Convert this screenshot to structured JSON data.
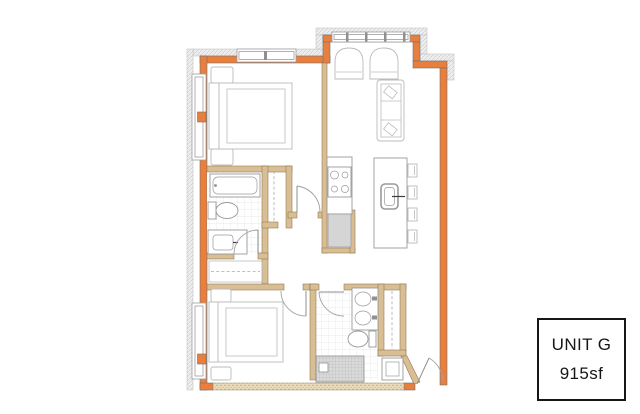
{
  "unit_label": {
    "name": "UNIT G",
    "area": "915sf"
  },
  "colors": {
    "exterior_wall": "#E87F3D",
    "interior_wall": "#D9BE93",
    "interior_wall_edge": "#8A7350",
    "wall_edge": "#707070",
    "hatch_fill": "#EDEDED",
    "hatch_line": "#BDBDBD",
    "fixture_line": "#9A9A9A",
    "furniture_line": "#BBBBBB",
    "appliance_fill": "#D5D5D5",
    "tile_line": "#E4E4E4",
    "shower_fill": "#DADADA",
    "shower_line": "#AFAFAF",
    "corridor_wall_fill": "#E8DBBA",
    "corridor_wall_dot": "#B19A67",
    "label_border": "#161616",
    "label_text": "#161616"
  }
}
